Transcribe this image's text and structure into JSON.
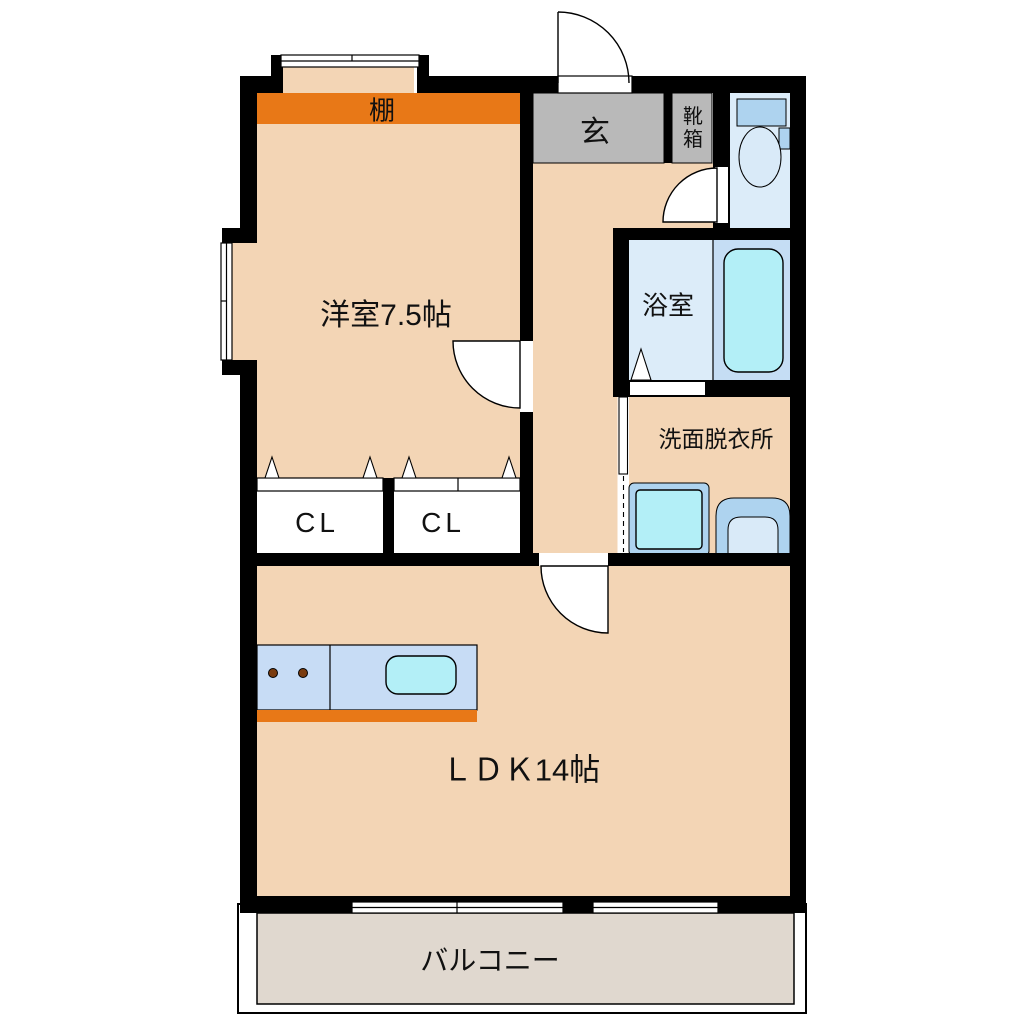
{
  "plan_title": "1LDK apartment floor plan",
  "colors": {
    "wall": "#000000",
    "peach": "#f3d5b5",
    "orange": "#e87817",
    "gray": "#b9b9b9",
    "roomBlue": "#dcecf9",
    "tubArea": "#c5ddf4",
    "water": "#b3eff7",
    "fixture": "#aed3ef",
    "fixtureLight": "#d9eaf8",
    "counter": "#c7dcf5",
    "balcony": "#e0d8cf",
    "burner": "#7a3c10"
  },
  "rooms": {
    "shelf": {
      "label": "棚"
    },
    "western": {
      "label": "洋室7.5帖"
    },
    "entrance": {
      "label": "玄"
    },
    "shoebox": {
      "label": "靴箱"
    },
    "bath": {
      "label": "浴室"
    },
    "washroom": {
      "label": "洗面脱衣所"
    },
    "closet_left": {
      "label": "CL"
    },
    "closet_right": {
      "label": "CL"
    },
    "ldk": {
      "label": "ＬＤＫ14帖"
    },
    "balcony": {
      "label": "バルコニー"
    }
  }
}
